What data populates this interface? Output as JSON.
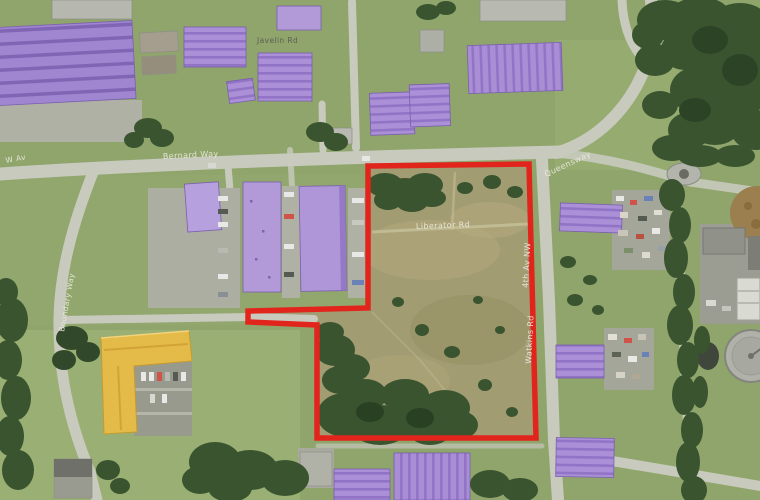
{
  "map": {
    "description_label": "",
    "labels": {
      "west_avenue": "W Av",
      "north_way": "Bernard Way",
      "northeast_road": "Queensway",
      "estate_road": "Javelin Rd",
      "centre_road": "Liberator Rd",
      "east_road_upper": "4th Av NW",
      "east_road_lower": "Watkins Rd",
      "west_road": "Boundary Way"
    },
    "colors": {
      "boundary": "#e2251c",
      "highlight_purple": "#ab90d8",
      "highlight_purple_dark": "#9174c5",
      "highlight_yellow": "#e4ba49",
      "road": "#c8cabd",
      "grass": "#8fa56c",
      "tree": "#3a5430"
    }
  }
}
